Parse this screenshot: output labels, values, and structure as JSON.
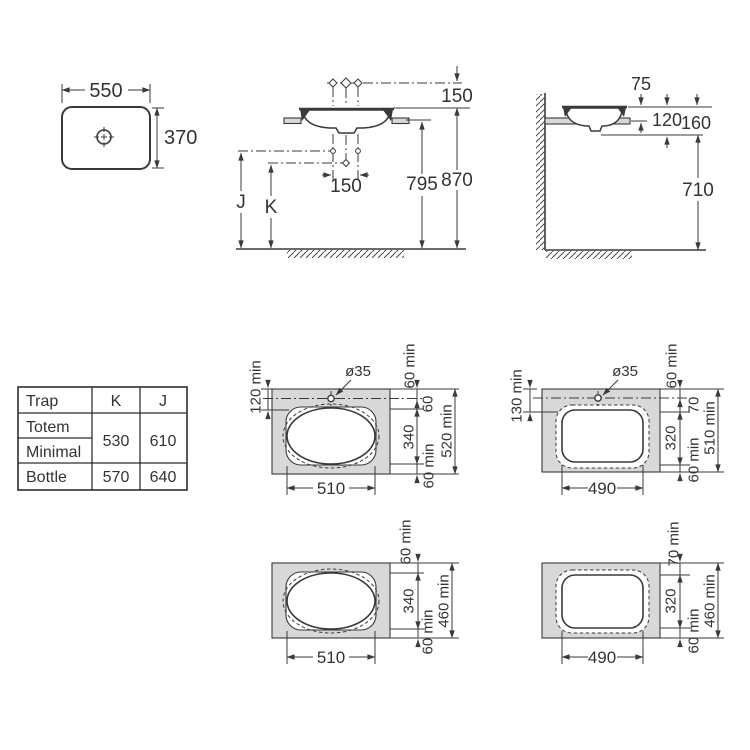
{
  "drawing_title": "Countertop basin installation dimensions",
  "top_view": {
    "width_label": "550",
    "depth_label": "370"
  },
  "front_view": {
    "faucet_height_label": "150",
    "faucet_spacing_label": "150",
    "counter_height_label": "795",
    "rim_height_label": "870",
    "trap_j_label": "J",
    "trap_k_label": "K"
  },
  "side_view": {
    "rim_above_counter_label": "75",
    "basin_inset_label": "120",
    "rim_to_underside_label": "160",
    "underside_height_label": "710"
  },
  "trap_table": {
    "header_trap": "Trap",
    "header_k": "K",
    "header_j": "J",
    "totem_label": "Totem",
    "minimal_label": "Minimal",
    "bottle_label": "Bottle",
    "totem_minimal_k": "530",
    "totem_minimal_j": "610",
    "bottle_k": "570",
    "bottle_j": "640"
  },
  "cutout_510_with_hole": {
    "hole_label": "ø35",
    "back_edge_label": "120 min",
    "top_margin_label": "60 min",
    "hole_to_cutout_label": "60",
    "depth_label": "340",
    "bottom_margin_label": "60 min",
    "total_depth_label": "520 min",
    "width_label": "510"
  },
  "cutout_490_with_hole": {
    "hole_label": "ø35",
    "back_edge_label": "130 min",
    "top_margin_label": "60 min",
    "hole_to_cutout_label": "70",
    "depth_label": "320",
    "bottom_margin_label": "60 min",
    "total_depth_label": "510 min",
    "width_label": "490"
  },
  "cutout_510_no_hole": {
    "top_margin_label": "60 min",
    "depth_label": "340",
    "bottom_margin_label": "60 min",
    "total_depth_label": "460 min",
    "width_label": "510"
  },
  "cutout_490_no_hole": {
    "top_margin_label": "70 min",
    "depth_label": "320",
    "bottom_margin_label": "60 min",
    "total_depth_label": "460 min",
    "width_label": "490"
  },
  "colors": {
    "line": "#3a3a3a",
    "counter_fill": "#d8d8d8",
    "background": "#ffffff"
  }
}
